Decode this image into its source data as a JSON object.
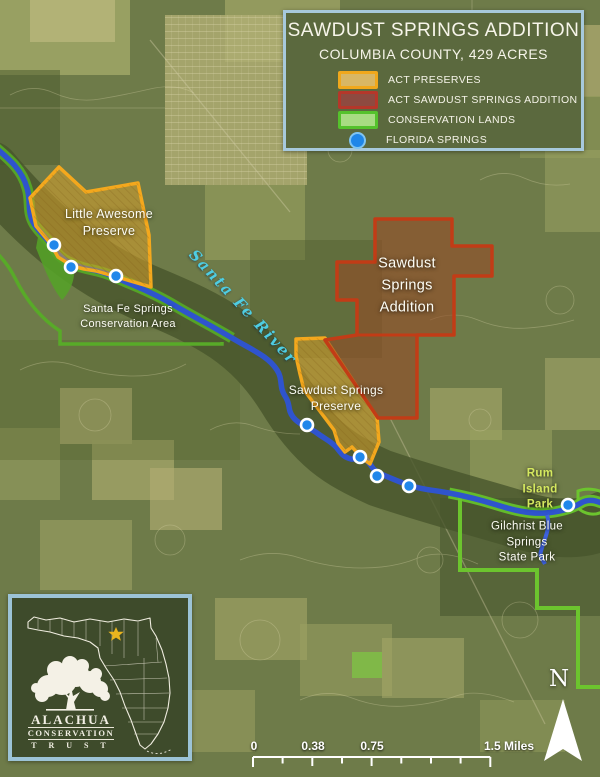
{
  "title_box": {
    "title": "SAWDUST SPRINGS ADDITION",
    "subtitle": "COLUMBIA COUNTY, 429 ACRES",
    "legend": [
      {
        "label": "ACT PRESERVES",
        "fill": "#d8b765",
        "border": "#f0a81c"
      },
      {
        "label": "ACT SAWDUST SPRINGS ADDITION",
        "fill": "#8e4a40",
        "border": "#b5372a"
      },
      {
        "label": "CONSERVATION LANDS",
        "fill": "#a8dc82",
        "border": "#55c22c"
      },
      {
        "label": "FLORIDA SPRINGS",
        "fill": "#1f86e8",
        "border": "#7fc4f2"
      }
    ]
  },
  "map_labels": {
    "little_awesome_preserve": "Little Awesome\nPreserve",
    "santa_fe_conservation": "Santa Fe Springs\nConservation Area",
    "santa_fe_river": "Santa Fe River",
    "sawdust_addition": "Sawdust\nSprings\nAddition",
    "sawdust_preserve": "Sawdust Springs\nPreserve",
    "rum_island": "Rum Island Park",
    "gilchrist": "Gilchrist Blue Springs\nState Park"
  },
  "springs": [
    [
      54,
      245
    ],
    [
      71,
      267
    ],
    [
      116,
      276
    ],
    [
      307,
      425
    ],
    [
      360,
      457
    ],
    [
      377,
      476
    ],
    [
      409,
      486
    ],
    [
      568,
      505
    ]
  ],
  "inset": {
    "logo_line1": "ALACHUA",
    "logo_line2": "CONSERVATION",
    "logo_line3": "T R U S T"
  },
  "north_arrow": {
    "label": "N"
  },
  "scale_bar": {
    "labels": [
      "0",
      "0.38",
      "0.75",
      "1.5 Miles"
    ]
  },
  "colors": {
    "panel_background": "#5b693e",
    "panel_border": "#a7c9dc",
    "inset_background": "#3e4b2b",
    "river": "#2f54cd",
    "spring_dot": "#2187ea",
    "preserve_fill": "rgba(216,160,42,0.55)",
    "preserve_border": "#f4a81d",
    "addition_fill": "rgba(150,74,38,0.58)",
    "addition_border": "#c23c16",
    "conservation_border": "#58aa28",
    "state_park_border": "#6cc42e",
    "river_label": "#4ecde2",
    "rum_island_label": "#d5e95f"
  }
}
